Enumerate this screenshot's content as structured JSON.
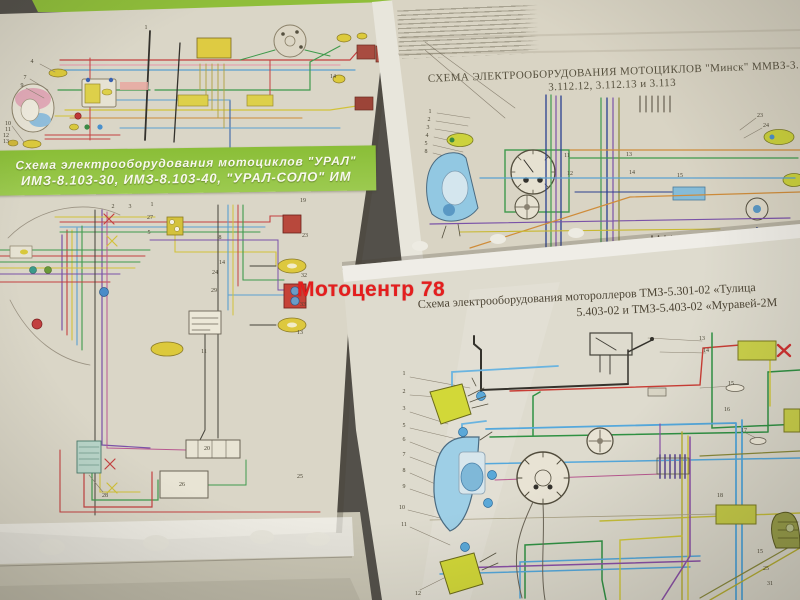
{
  "photo": {
    "description": "photo of motorcycle wiring diagram posters in plastic sleeves",
    "watermark": {
      "text": "Мотоцентр 78",
      "color": "#e41e1e"
    },
    "colors": {
      "background": "#53504a",
      "paper": "#dad6c7",
      "banner_green": "#8abe37",
      "wire_red": "#c44040",
      "wire_blue": "#5aa0d0",
      "wire_green": "#3f9a4c",
      "wire_yellow": "#d2c23a",
      "wire_purple": "#7a52a8"
    },
    "sheets": {
      "ural": {
        "banner_line1": "Схема электрооборудования мотоциклов \"УРАЛ\"",
        "banner_line2": "ИМЗ-8.103-30, ИМЗ-8.103-40, \"УРАЛ-СОЛО\" ИМ"
      },
      "minsk": {
        "title_line1": "СХЕМА ЭЛЕКТРООБОРУДОВАНИЯ МОТОЦИКЛОВ \"Минск\" ММВЗ-3.11",
        "title_line2": "3.112.12, 3.112.13 и 3.113"
      },
      "tulitsa": {
        "title_line1": "Схема электрооборудования мотороллеров ТМЗ-5.301-02 «Тулица",
        "title_line2": "5.403-02 и ТМЗ-5.403-02 «Муравей-2М"
      }
    },
    "callouts": [
      {
        "t": "1",
        "x": 146,
        "y": 28
      },
      {
        "t": "4",
        "x": 32,
        "y": 62
      },
      {
        "t": "7",
        "x": 25,
        "y": 78
      },
      {
        "t": "9",
        "x": 22,
        "y": 86
      },
      {
        "t": "10",
        "x": 8,
        "y": 124
      },
      {
        "t": "11",
        "x": 8,
        "y": 130
      },
      {
        "t": "12",
        "x": 6,
        "y": 136
      },
      {
        "t": "13",
        "x": 6,
        "y": 142
      },
      {
        "t": "14",
        "x": 333,
        "y": 77
      },
      {
        "t": "2",
        "x": 113,
        "y": 207
      },
      {
        "t": "3",
        "x": 130,
        "y": 207
      },
      {
        "t": "1",
        "x": 152,
        "y": 205
      },
      {
        "t": "27",
        "x": 150,
        "y": 218
      },
      {
        "t": "5",
        "x": 149,
        "y": 233
      },
      {
        "t": "8",
        "x": 220,
        "y": 238
      },
      {
        "t": "19",
        "x": 303,
        "y": 201
      },
      {
        "t": "23",
        "x": 305,
        "y": 236
      },
      {
        "t": "14",
        "x": 222,
        "y": 263
      },
      {
        "t": "24",
        "x": 215,
        "y": 273
      },
      {
        "t": "29",
        "x": 214,
        "y": 291
      },
      {
        "t": "32",
        "x": 304,
        "y": 276
      },
      {
        "t": "33",
        "x": 303,
        "y": 305
      },
      {
        "t": "13",
        "x": 300,
        "y": 333
      },
      {
        "t": "11",
        "x": 204,
        "y": 352
      },
      {
        "t": "28",
        "x": 105,
        "y": 496
      },
      {
        "t": "20",
        "x": 207,
        "y": 449
      },
      {
        "t": "26",
        "x": 182,
        "y": 485
      },
      {
        "t": "25",
        "x": 300,
        "y": 477
      },
      {
        "t": "1",
        "x": 430,
        "y": 112
      },
      {
        "t": "2",
        "x": 429,
        "y": 120
      },
      {
        "t": "3",
        "x": 428,
        "y": 128
      },
      {
        "t": "4",
        "x": 427,
        "y": 136
      },
      {
        "t": "5",
        "x": 426,
        "y": 144
      },
      {
        "t": "8",
        "x": 426,
        "y": 152
      },
      {
        "t": "11",
        "x": 567,
        "y": 156
      },
      {
        "t": "12",
        "x": 570,
        "y": 174
      },
      {
        "t": "13",
        "x": 629,
        "y": 155
      },
      {
        "t": "14",
        "x": 632,
        "y": 173
      },
      {
        "t": "15",
        "x": 680,
        "y": 176
      },
      {
        "t": "23",
        "x": 760,
        "y": 116
      },
      {
        "t": "24",
        "x": 766,
        "y": 126
      },
      {
        "t": "1",
        "x": 404,
        "y": 374
      },
      {
        "t": "2",
        "x": 404,
        "y": 392
      },
      {
        "t": "3",
        "x": 404,
        "y": 409
      },
      {
        "t": "5",
        "x": 404,
        "y": 426
      },
      {
        "t": "6",
        "x": 404,
        "y": 440
      },
      {
        "t": "7",
        "x": 404,
        "y": 455
      },
      {
        "t": "8",
        "x": 404,
        "y": 471
      },
      {
        "t": "9",
        "x": 404,
        "y": 487
      },
      {
        "t": "10",
        "x": 402,
        "y": 508
      },
      {
        "t": "11",
        "x": 404,
        "y": 525
      },
      {
        "t": "12",
        "x": 418,
        "y": 594
      },
      {
        "t": "13",
        "x": 702,
        "y": 339
      },
      {
        "t": "14",
        "x": 706,
        "y": 351
      },
      {
        "t": "15",
        "x": 731,
        "y": 384
      },
      {
        "t": "16",
        "x": 727,
        "y": 410
      },
      {
        "t": "17",
        "x": 744,
        "y": 431
      },
      {
        "t": "18",
        "x": 720,
        "y": 496
      },
      {
        "t": "15",
        "x": 760,
        "y": 552
      },
      {
        "t": "25",
        "x": 766,
        "y": 569
      },
      {
        "t": "31",
        "x": 770,
        "y": 584
      }
    ]
  }
}
